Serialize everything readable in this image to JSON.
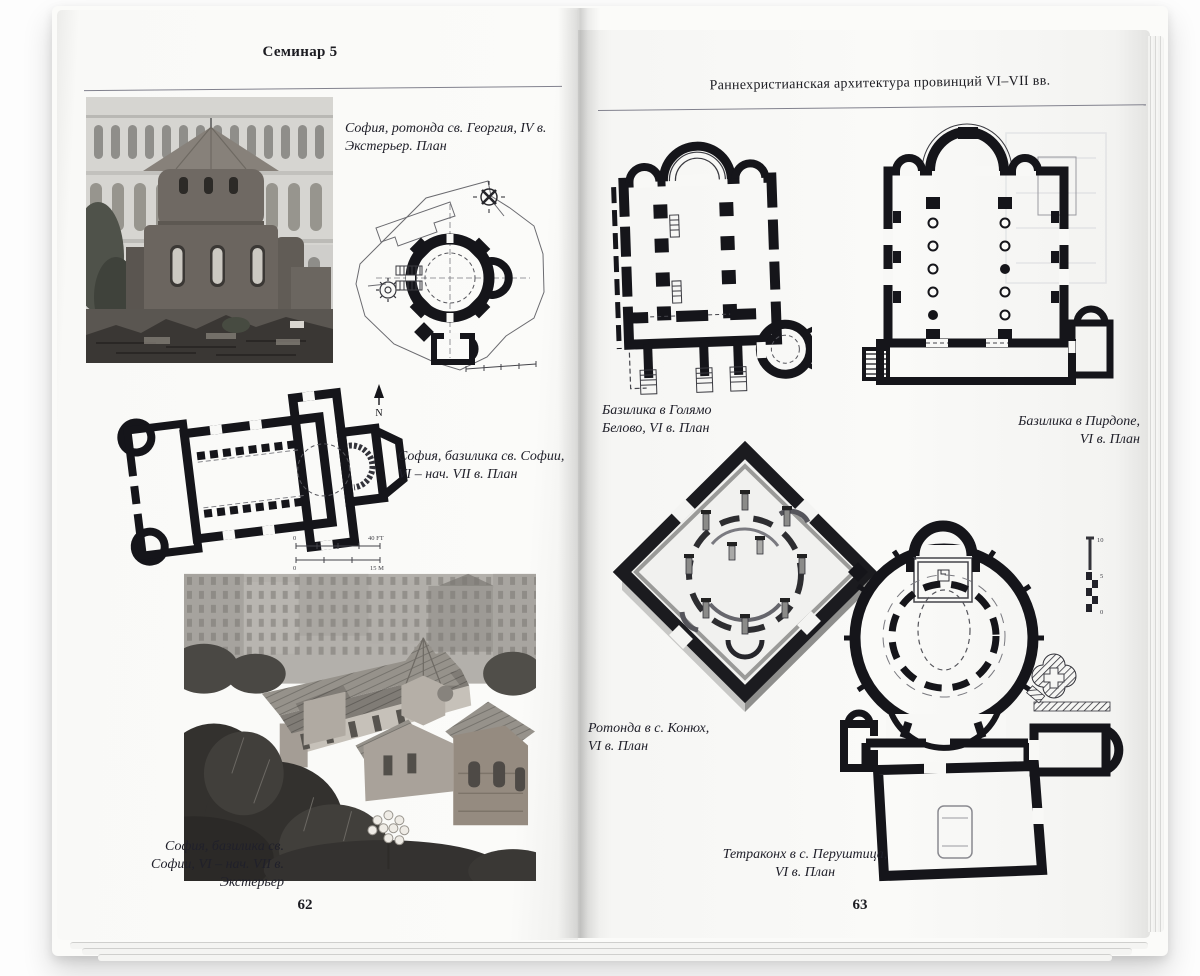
{
  "left": {
    "header": "Семинар 5",
    "page_number": "62",
    "cap_rotunda": "София, ротонда св. Георгия, IV в.\nЭкстерьер. План",
    "cap_plan": "София, базилика св. Софии,\nVI – нач. VII в. План",
    "cap_photo": "София, базилика св.\nСофии, VI – нач. VII в.\nЭкстерьер",
    "north": "N",
    "scale_ft": "40 FT",
    "scale_m": "15 M",
    "zero": "0"
  },
  "right": {
    "header": "Раннехристианская архитектура провинций VI–VII вв.",
    "page_number": "63",
    "cap_golyamo": "Базилика в Голямо\nБелово, VI в. План",
    "cap_pirdop": "Базилика в Пирдопе,\nVI в. План",
    "cap_konyukh": "Ротонда в с. Конюх,\nVI в. План",
    "cap_tetraconch": "Тетраконх в с. Перуштица,\nVI в. План",
    "scale_10": "10",
    "scale_5": "5",
    "scale_0": "0"
  }
}
